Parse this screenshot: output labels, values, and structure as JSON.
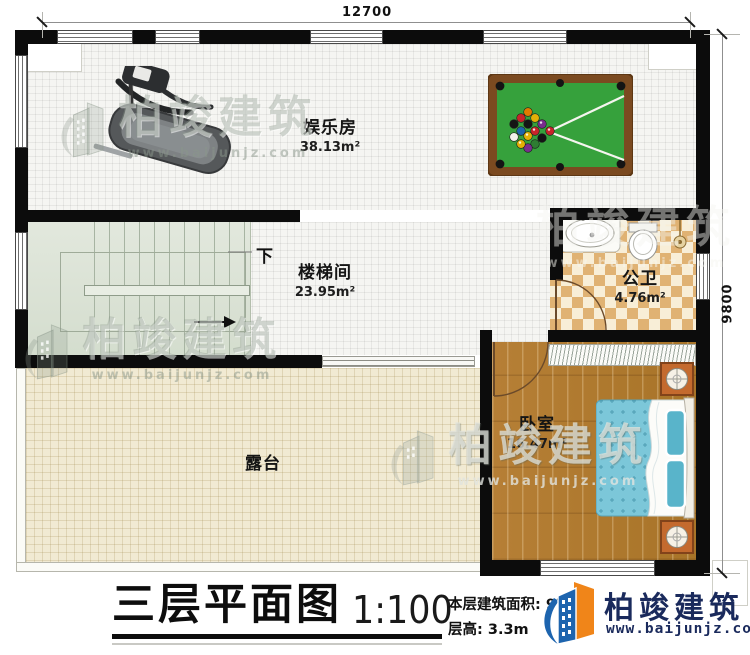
{
  "dimensions": {
    "top_width": "12700",
    "right_height": "9800"
  },
  "rooms": {
    "entertainment": {
      "name": "娱乐房",
      "area": "38.13m²"
    },
    "stairwell": {
      "name": "楼梯间",
      "area": "23.95m²"
    },
    "bathroom": {
      "name": "公卫",
      "area": "4.76m²"
    },
    "bedroom": {
      "name": "卧室",
      "area": "16.47m²"
    },
    "terrace": {
      "name": "露台"
    }
  },
  "annotations": {
    "stairs_direction": "下"
  },
  "title_block": {
    "plan_title": "三层平面图",
    "scale": "1:100",
    "area_label": "本层建筑面积:",
    "area_value": "97",
    "area_unit": "m²",
    "floor_height_label": "层高:",
    "floor_height_value": "3.3m"
  },
  "brand": {
    "name": "柏竣建筑",
    "website": "www.baijunjz.com"
  },
  "watermark": {
    "name": "柏竣建筑",
    "website": "www.baijunjz.com"
  },
  "colors": {
    "wall": "#0c0c0c",
    "brand_navy": "#1a2a5c",
    "brand_orange": "#f08519",
    "brand_blue": "#1d64ae",
    "billiard_felt": "#36a13c",
    "billiard_frame": "#7b4a20",
    "bed": "#7cc7d9",
    "wood_floor": "#b07a33",
    "terrace_floor": "#f1ead3",
    "stair_floor": "#dde4d8",
    "bathroom_tile": "#e0b273"
  }
}
